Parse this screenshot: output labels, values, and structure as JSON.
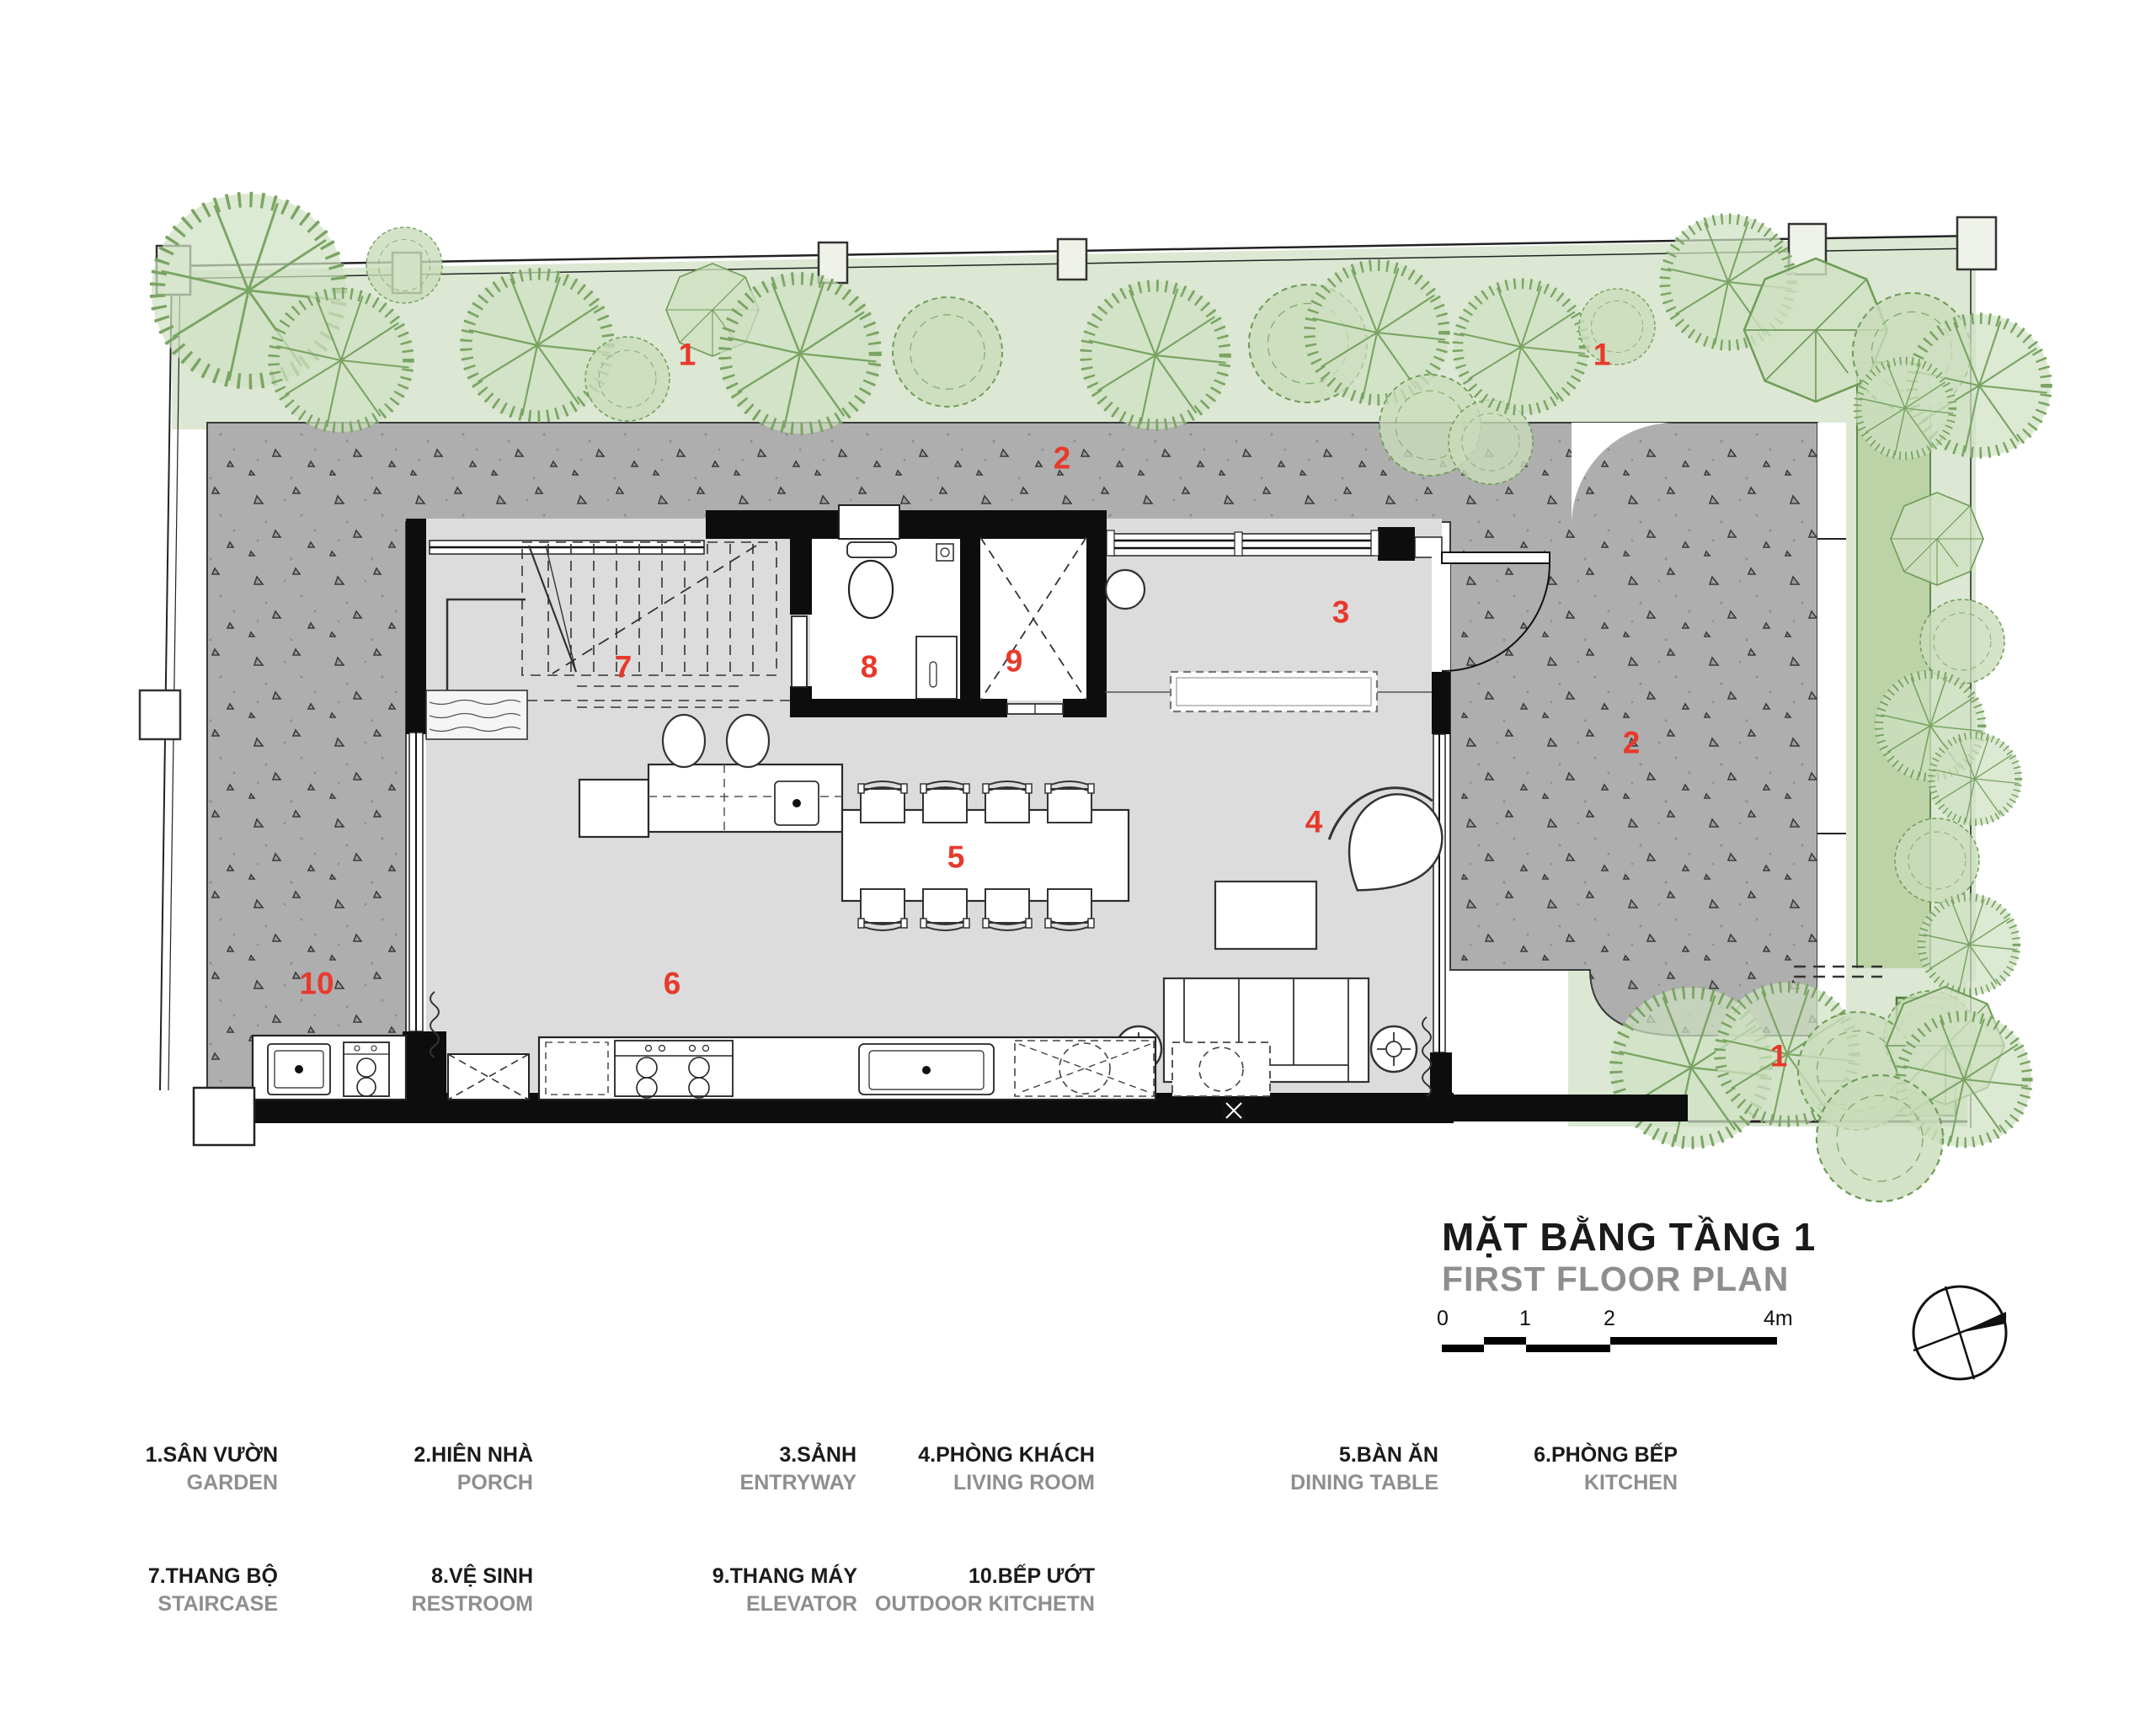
{
  "title": {
    "main": "MẶT BẰNG TẦNG 1",
    "sub": "FIRST FLOOR PLAN"
  },
  "scale_bar": {
    "labels": [
      "0",
      "1",
      "2",
      "4m"
    ]
  },
  "markers": {
    "garden_top_left": "1",
    "garden_top_right": "1",
    "garden_bottom_right": "1",
    "porch_top": "2",
    "porch_right": "2",
    "entry": "3",
    "living": "4",
    "dining": "5",
    "kitchen": "6",
    "stair": "7",
    "restroom": "8",
    "elevator": "9",
    "outdoor_kitchen": "10"
  },
  "legend": {
    "row1": [
      {
        "vi": "1.SÂN VƯỜN",
        "en": "GARDEN"
      },
      {
        "vi": "2.HIÊN NHÀ",
        "en": "PORCH"
      },
      {
        "vi": "3.SẢNH",
        "en": "ENTRYWAY"
      },
      {
        "vi": "4.PHÒNG KHÁCH",
        "en": "LIVING ROOM"
      },
      {
        "vi": "5.BÀN ĂN",
        "en": "DINING TABLE"
      },
      {
        "vi": "6.PHÒNG BẾP",
        "en": "KITCHEN"
      }
    ],
    "row2": [
      {
        "vi": "7.THANG BỘ",
        "en": "STAIRCASE"
      },
      {
        "vi": "8.VỆ SINH",
        "en": "RESTROOM"
      },
      {
        "vi": "9.THANG MÁY",
        "en": "ELEVATOR"
      },
      {
        "vi": "10.BẾP ƯỚT",
        "en": "OUTDOOR KITCHETN"
      }
    ]
  }
}
